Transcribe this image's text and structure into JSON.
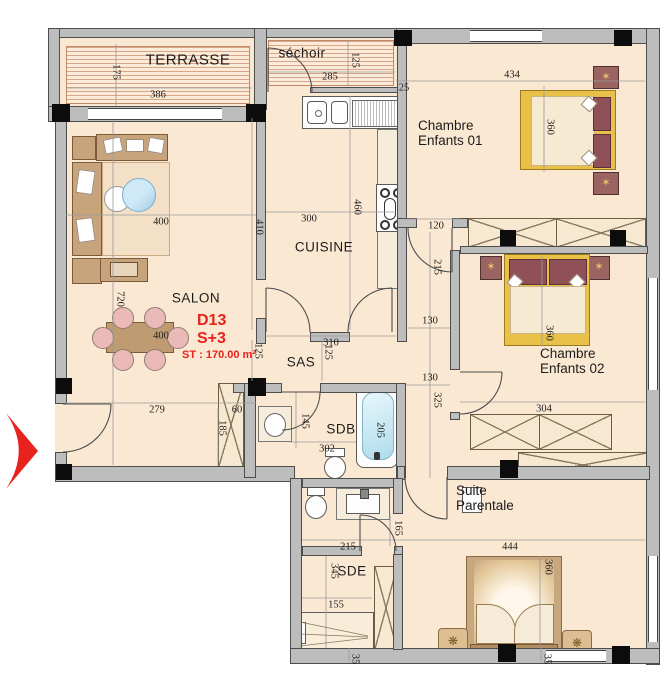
{
  "plan": {
    "code": "D13",
    "type": "S+3",
    "area": "ST : 170.00 m²"
  },
  "colors": {
    "accent": "#e8221c",
    "wall": "#bdbdbd",
    "floor": "#fae8d2",
    "hatch_line": "#c36e50"
  },
  "rooms": {
    "terrasse": "TERRASSE",
    "sechoir": "séchoir",
    "cuisine": "CUISINE",
    "salon": "SALON",
    "sas": "SAS",
    "sdb": "SDB",
    "sde": "SDE",
    "chambre1_l1": "Chambre",
    "chambre1_l2": "Enfants 01",
    "chambre2_l1": "Chambre",
    "chambre2_l2": "Enfants 02",
    "suite_l1": "Suite",
    "suite_l2": "Parentale"
  },
  "dims": [
    "175",
    "386",
    "285",
    "125",
    "25",
    "434",
    "360",
    "120",
    "300",
    "460",
    "410",
    "400",
    "720",
    "400",
    "215",
    "310",
    "125",
    "125",
    "130",
    "279",
    "60",
    "185",
    "145",
    "302",
    "205",
    "130",
    "325",
    "360",
    "304",
    "444",
    "360",
    "215",
    "165",
    "345",
    "155",
    "35",
    "35"
  ]
}
